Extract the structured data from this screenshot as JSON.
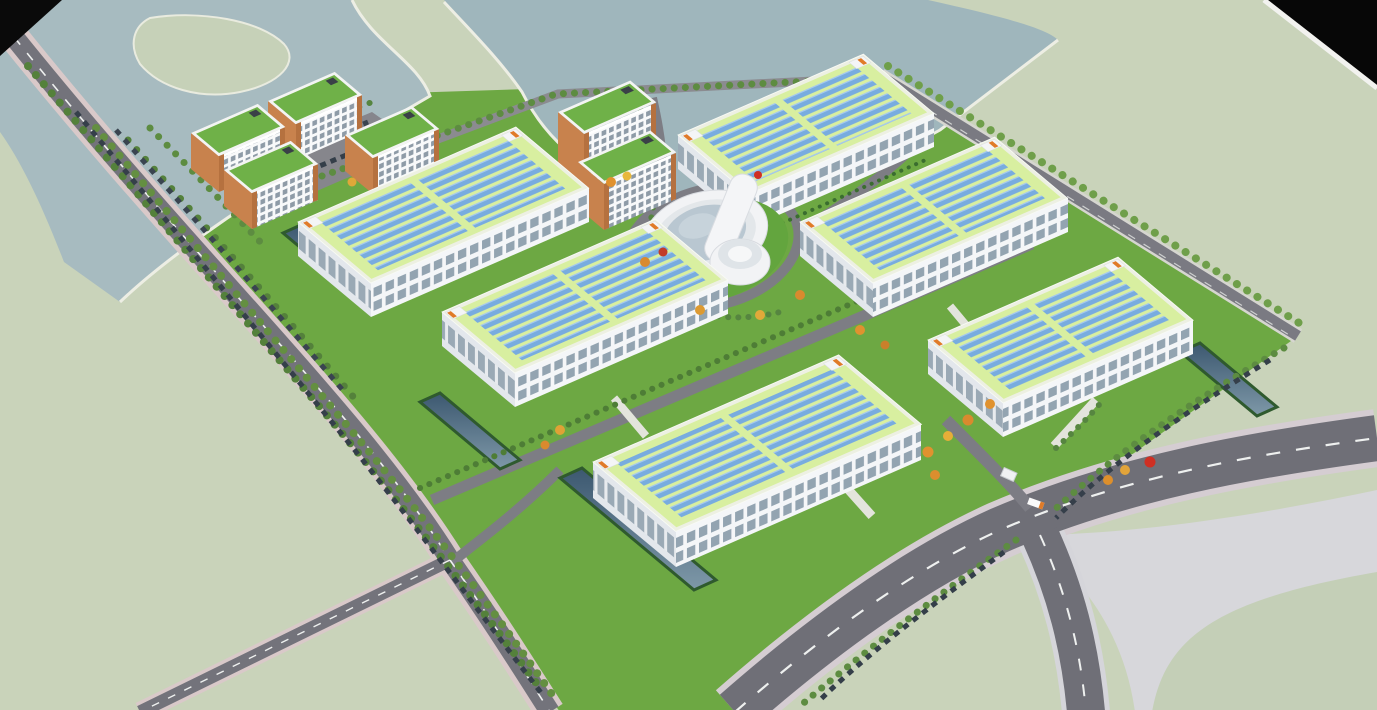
{
  "scene": {
    "type": "3d-architectural-rendering",
    "subject": "Aerial rendering of an industrial park campus with rooftop solar panels",
    "view": "oblique bird's-eye from south-west",
    "caption": "Aerial rendering of an industrial park campus with rooftop solar panels",
    "environment": {
      "water_bodies": 2,
      "water_location": "top-left and top-center lakes with white shorelines",
      "surroundings": "pale sage-green open fields",
      "corner_cutoffs": "black clipped triangles at top-left and top-right corners"
    }
  },
  "buildings": {
    "solar_factories": {
      "count": 6,
      "style": "large white multi-storey plants, lime-green roofs with two banks of blue photovoltaic rows, white parapets, rooftop stair boxes with orange doors, two window bands per facade"
    },
    "dormitory_blocks": {
      "count": 4,
      "style": "white slabs with dense window grids, orange-brown corner trim, green flat roofs"
    },
    "office_towers": {
      "count": 2,
      "style": "taller white towers with window grids, orange-brown trim, green roofs"
    },
    "admin_center": {
      "count": 1,
      "style": "circular white building with glass atrium, diagonal bar wing and attached white rotunda"
    },
    "gatehouse": {
      "count": 1,
      "location": "south-east entrance"
    }
  },
  "infrastructure": {
    "perimeter_roads": "tree-lined loop with parallel parking full of dark cars",
    "highway": "wide curved arterial with dashed lane lines at bottom-right, Y-junction with light sidewalk wedge",
    "internal_roads": "grey lanes between factory rows and a ring around the admin center",
    "retention_ponds": 4,
    "parking_lot": "north-west corner lot with two car rows",
    "walkways": "short light concrete paths at building entrances"
  },
  "vegetation": {
    "street_trees": "continuous green tree rows along every road",
    "autumn_trees": "orange, amber and red trees scattered near the center, east lawns and gate",
    "hedges": "dark green bush rows along factory facades and ponds",
    "lawns": "bright green campus ground inside the loop"
  },
  "palette": {
    "land": "#c9d3ba",
    "campus_lawn": "#6da843",
    "water": "#a2b8be",
    "shoreline": "#edeee4",
    "road_asphalt": "#72727a",
    "road_sidewalk_pink": "#d9c9c9",
    "highway_sidewalk": "#d5d5da",
    "lane_dash": "#eef0ef",
    "factory_wall": "#f4f6f8",
    "factory_wall_shade": "#e3e7ec",
    "window_glass": "#93a4b1",
    "roof_parapet": "#edf0e3",
    "roof_field": "#d8efa0",
    "solar_panel": "#78acdf",
    "dorm_trim": "#b5713f",
    "dorm_roof": "#6fb148",
    "tree_green": "#5d8c41",
    "autumn_orange": "#e0922f",
    "autumn_red": "#c7301f",
    "pond_water": "#3c5870",
    "car_body": "#353f4a",
    "corner_black": "#0a0a0a"
  }
}
